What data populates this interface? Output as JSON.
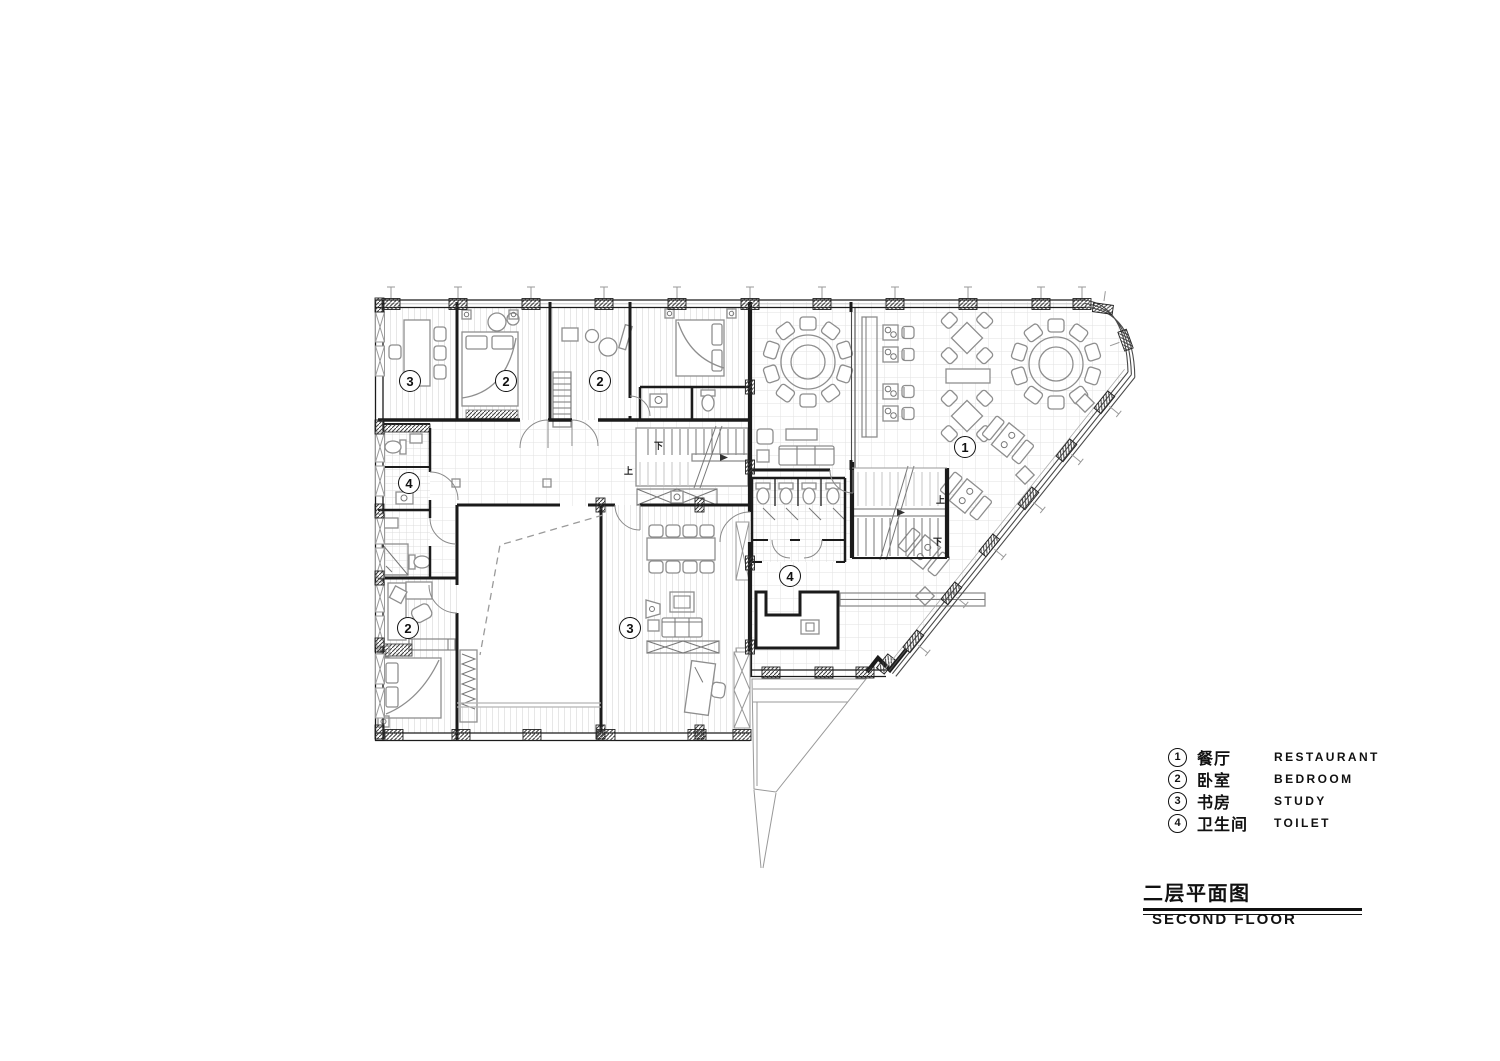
{
  "drawing": {
    "type": "architectural-floor-plan",
    "background": "#ffffff",
    "wall_color": "#1b1b1b",
    "furniture_color": "#8e8e8e",
    "floor_hatch_color": "#e2e2e2"
  },
  "plan": {
    "stair_up": "上",
    "stair_down": "下",
    "room_labels": [
      {
        "room": "study",
        "num": "3"
      },
      {
        "room": "bedroom",
        "num": "2"
      },
      {
        "room": "bedroom",
        "num": "2"
      },
      {
        "room": "restaurant",
        "num": "1"
      },
      {
        "room": "toilet",
        "num": "4"
      },
      {
        "room": "toilet",
        "num": "4"
      },
      {
        "room": "bedroom",
        "num": "2"
      },
      {
        "room": "study",
        "num": "3"
      }
    ]
  },
  "legend": {
    "items": [
      {
        "num": "1",
        "zh": "餐厅",
        "en": "RESTAURANT"
      },
      {
        "num": "2",
        "zh": "卧室",
        "en": "BEDROOM"
      },
      {
        "num": "3",
        "zh": "书房",
        "en": "STUDY"
      },
      {
        "num": "4",
        "zh": "卫生间",
        "en": "TOILET"
      }
    ]
  },
  "title": {
    "zh": "二层平面图",
    "en": "SECOND FLOOR"
  }
}
